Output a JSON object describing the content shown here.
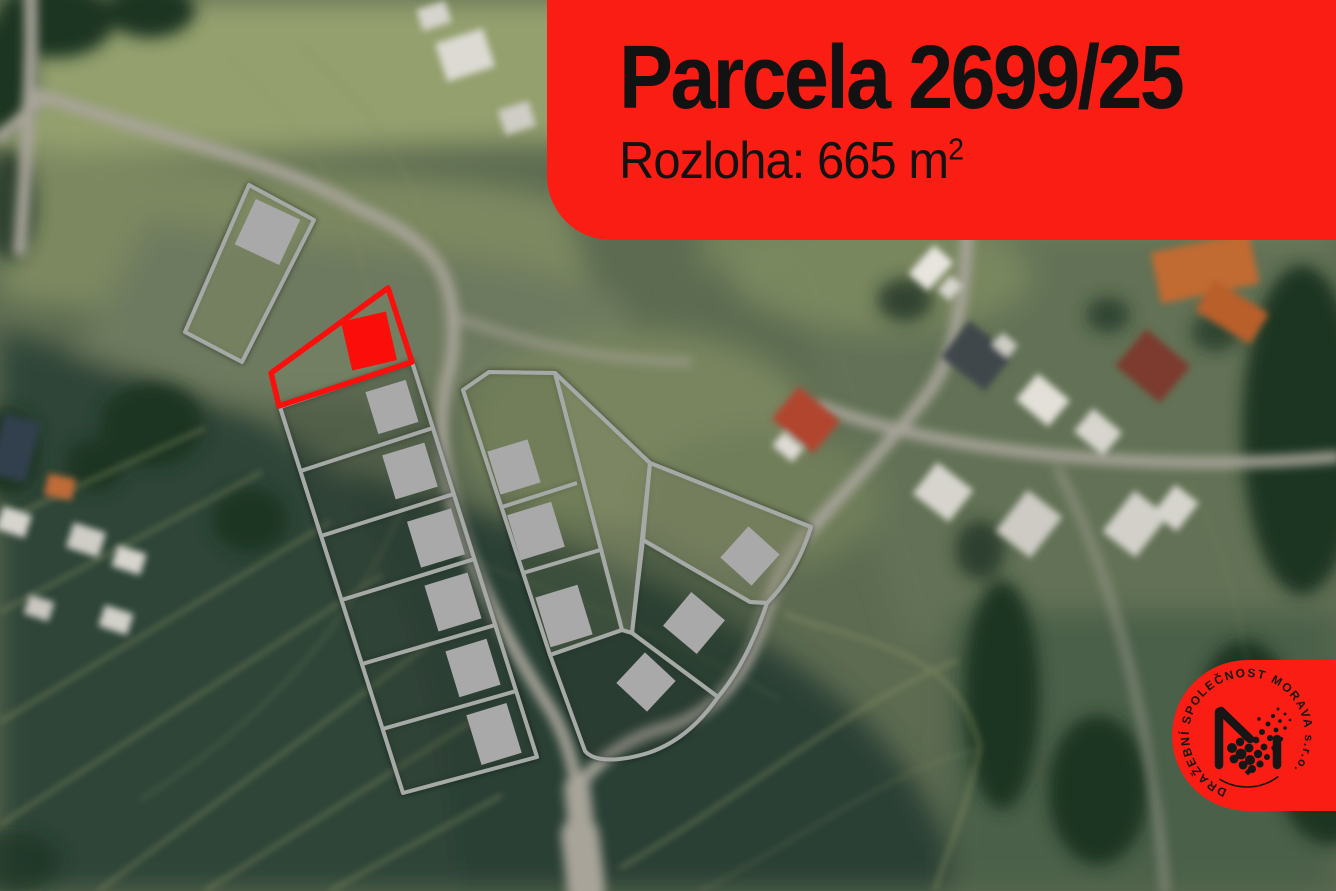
{
  "banner": {
    "parcel_title": "Parcela 2699/25",
    "area_label": "Rozloha: 665 m",
    "area_superscript": "2",
    "background_color": "#f91d13",
    "text_color": "#121212"
  },
  "map": {
    "highlight_color": "#f90f0c",
    "parcel_outline_color": "#a6aaa7",
    "building_footprint_color": "#a9a9a9",
    "highlighted_building_color": "#fb0d09"
  },
  "logo": {
    "text": "DRAŽEBNÍ SPOLEČNOST MORAVA s.r.o.",
    "background_color": "#f91d13",
    "text_color": "#161616"
  }
}
